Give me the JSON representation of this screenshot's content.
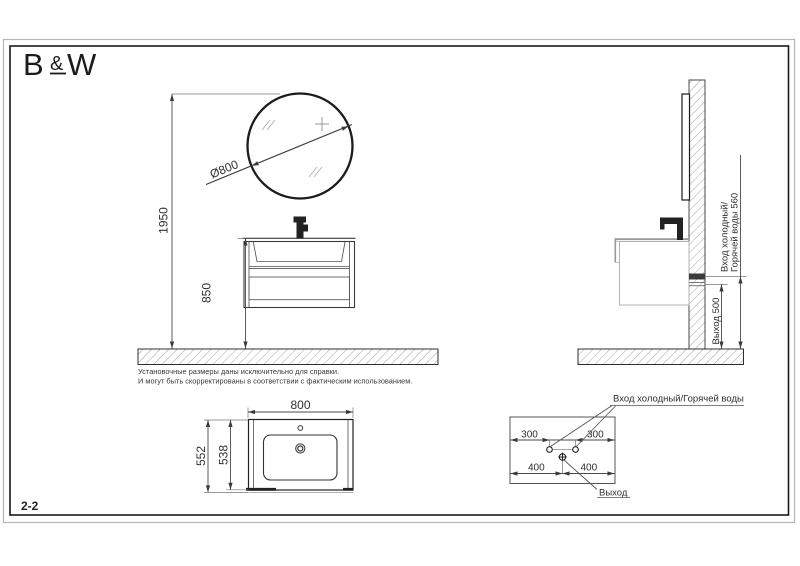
{
  "logo": {
    "b": "B",
    "amp": "&",
    "w": "W"
  },
  "sheet": {
    "number": "2-2"
  },
  "notes": {
    "line1": "Установочные размеры даны исключительно для справки.",
    "line2": "И могут быть скорректированы в соответствии с фактическим использованием."
  },
  "front_view": {
    "mirror_diameter": "Ø800",
    "total_height": "1950",
    "cabinet_height": "850"
  },
  "side_view": {
    "inlet_line1": "Вход холодный/",
    "inlet_line2": "Горячей воды 560",
    "outlet": "Выход 500"
  },
  "top_view": {
    "width": "800",
    "depth_outer": "552",
    "depth_inner": "538"
  },
  "wall_layout": {
    "inlet_label": "Вход холодный/Горячей воды",
    "outlet_label": "Выход",
    "left_300": "300",
    "right_300": "300",
    "left_400": "400",
    "right_400": "400"
  },
  "colors": {
    "line": "#2f2f2f",
    "dimension": "#4a4a4a",
    "hatch": "#999999",
    "side_view_gray": "#a9a9a9",
    "inner_border": "#1a1a1a",
    "outer_border": "#b5b5b5"
  }
}
